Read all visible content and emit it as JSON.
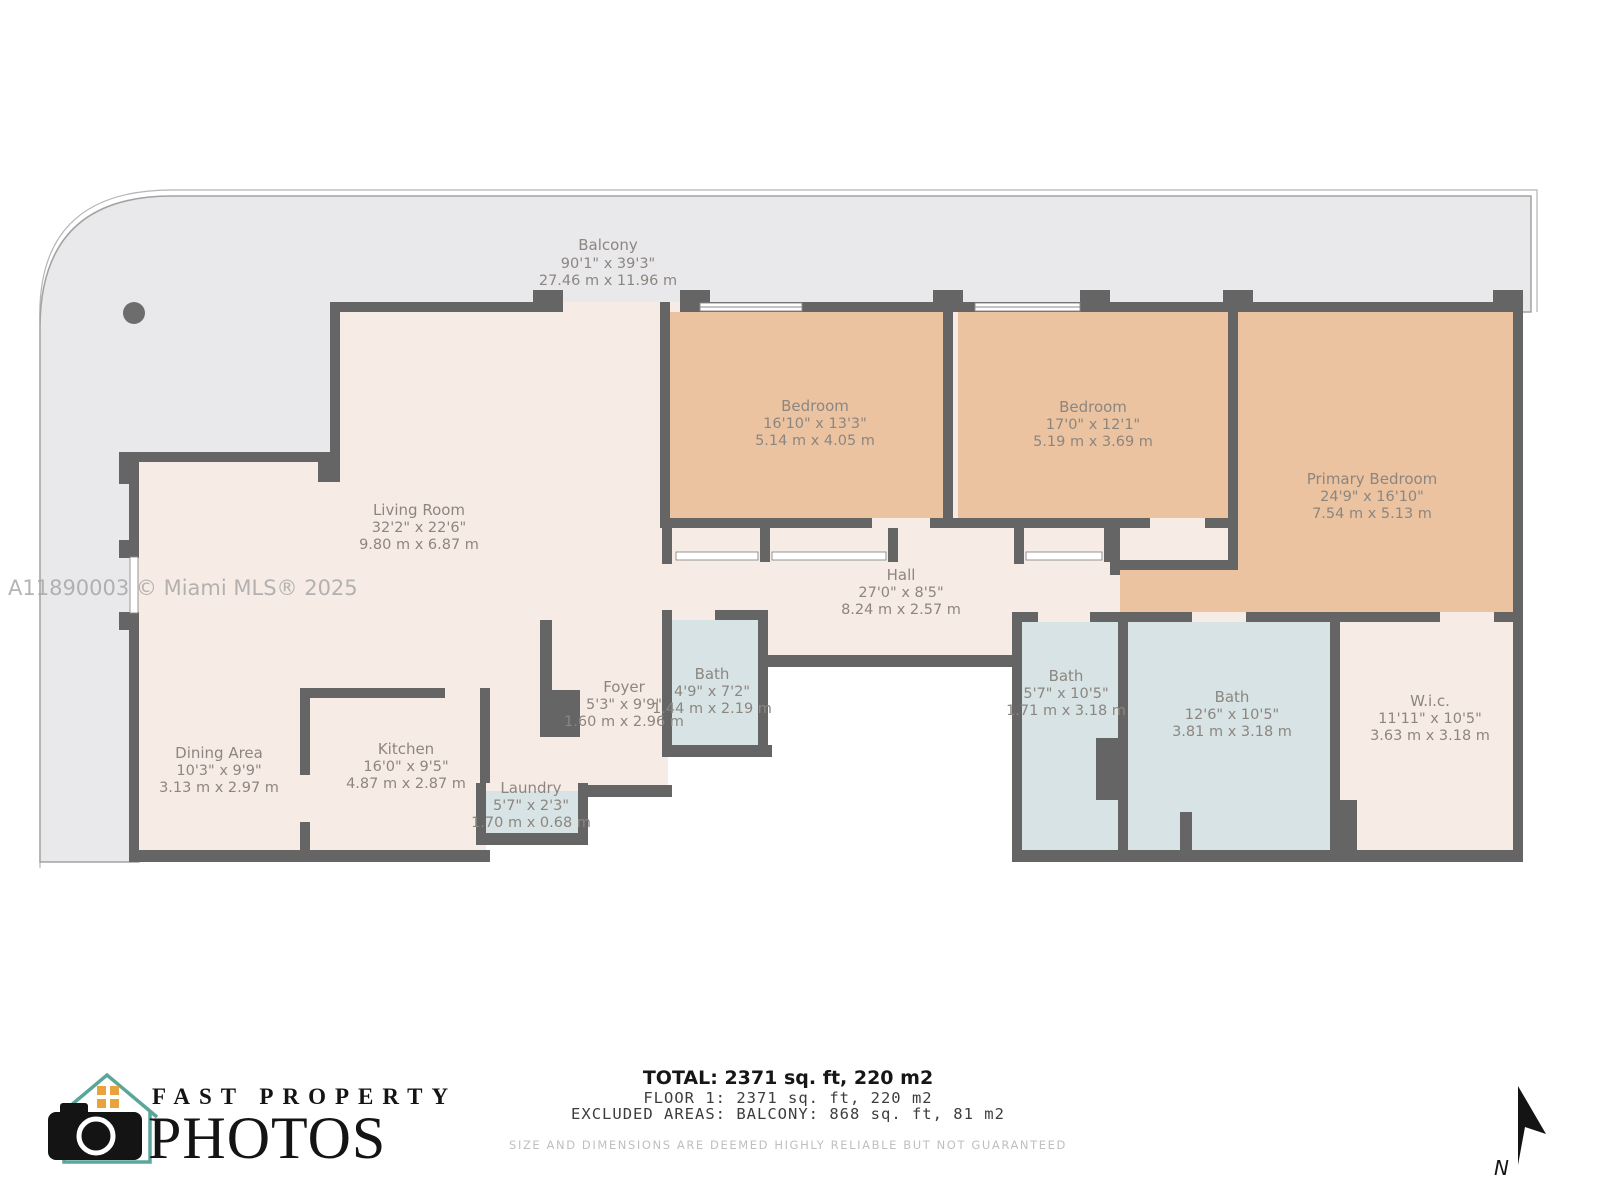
{
  "watermark": "A11890003 © Miami MLS® 2025",
  "rooms": [
    {
      "id": "balcony",
      "name": "Balcony",
      "dims_ft": "90'1\" x 39'3\"",
      "dims_m": "27.46 m x 11.96 m"
    },
    {
      "id": "living-room",
      "name": "Living Room",
      "dims_ft": "32'2\" x 22'6\"",
      "dims_m": "9.80 m x 6.87 m"
    },
    {
      "id": "bedroom-1",
      "name": "Bedroom",
      "dims_ft": "16'10\" x 13'3\"",
      "dims_m": "5.14 m x 4.05 m"
    },
    {
      "id": "bedroom-2",
      "name": "Bedroom",
      "dims_ft": "17'0\" x 12'1\"",
      "dims_m": "5.19 m x 3.69 m"
    },
    {
      "id": "primary-bedroom",
      "name": "Primary Bedroom",
      "dims_ft": "24'9\" x 16'10\"",
      "dims_m": "7.54 m x 5.13 m"
    },
    {
      "id": "hall",
      "name": "Hall",
      "dims_ft": "27'0\" x 8'5\"",
      "dims_m": "8.24 m x 2.57 m"
    },
    {
      "id": "foyer",
      "name": "Foyer",
      "dims_ft": "5'3\" x 9'9\"",
      "dims_m": "1.60 m x 2.96 m"
    },
    {
      "id": "bath-foyer",
      "name": "Bath",
      "dims_ft": "4'9\" x 7'2\"",
      "dims_m": "1.44 m x 2.19 m"
    },
    {
      "id": "dining-area",
      "name": "Dining Area",
      "dims_ft": "10'3\" x 9'9\"",
      "dims_m": "3.13 m x 2.97 m"
    },
    {
      "id": "kitchen",
      "name": "Kitchen",
      "dims_ft": "16'0\" x 9'5\"",
      "dims_m": "4.87 m x 2.87 m"
    },
    {
      "id": "laundry",
      "name": "Laundry",
      "dims_ft": "5'7\" x 2'3\"",
      "dims_m": "1.70 m x 0.68 m"
    },
    {
      "id": "bath-a",
      "name": "Bath",
      "dims_ft": "5'7\" x 10'5\"",
      "dims_m": "1.71 m x 3.18 m"
    },
    {
      "id": "bath-b",
      "name": "Bath",
      "dims_ft": "12'6\" x 10'5\"",
      "dims_m": "3.81 m x 3.18 m"
    },
    {
      "id": "wic",
      "name": "W.i.c.",
      "dims_ft": "11'11\" x 10'5\"",
      "dims_m": "3.63 m x 3.18 m"
    }
  ],
  "footer": {
    "total": "TOTAL: 2371 sq. ft, 220 m2",
    "floor": "FLOOR 1: 2371 sq. ft, 220 m2",
    "excluded": "EXCLUDED AREAS: BALCONY: 868 sq. ft, 81 m2",
    "disclaimer": "SIZE AND DIMENSIONS ARE DEEMED HIGHLY RELIABLE BUT NOT GUARANTEED"
  },
  "logo": {
    "line1": "FAST PROPERTY",
    "line2": "PHOTOS"
  },
  "compass": {
    "label": "N"
  },
  "colors": {
    "balcony": "#e9e9eb",
    "interior": "#f7ece5",
    "bedroom": "#ebc3a0",
    "bath": "#d7e3e5",
    "wall": "#656565",
    "label_text": "#8c8680",
    "logo_teal": "#5aa79a",
    "logo_orange": "#e8a33d"
  }
}
